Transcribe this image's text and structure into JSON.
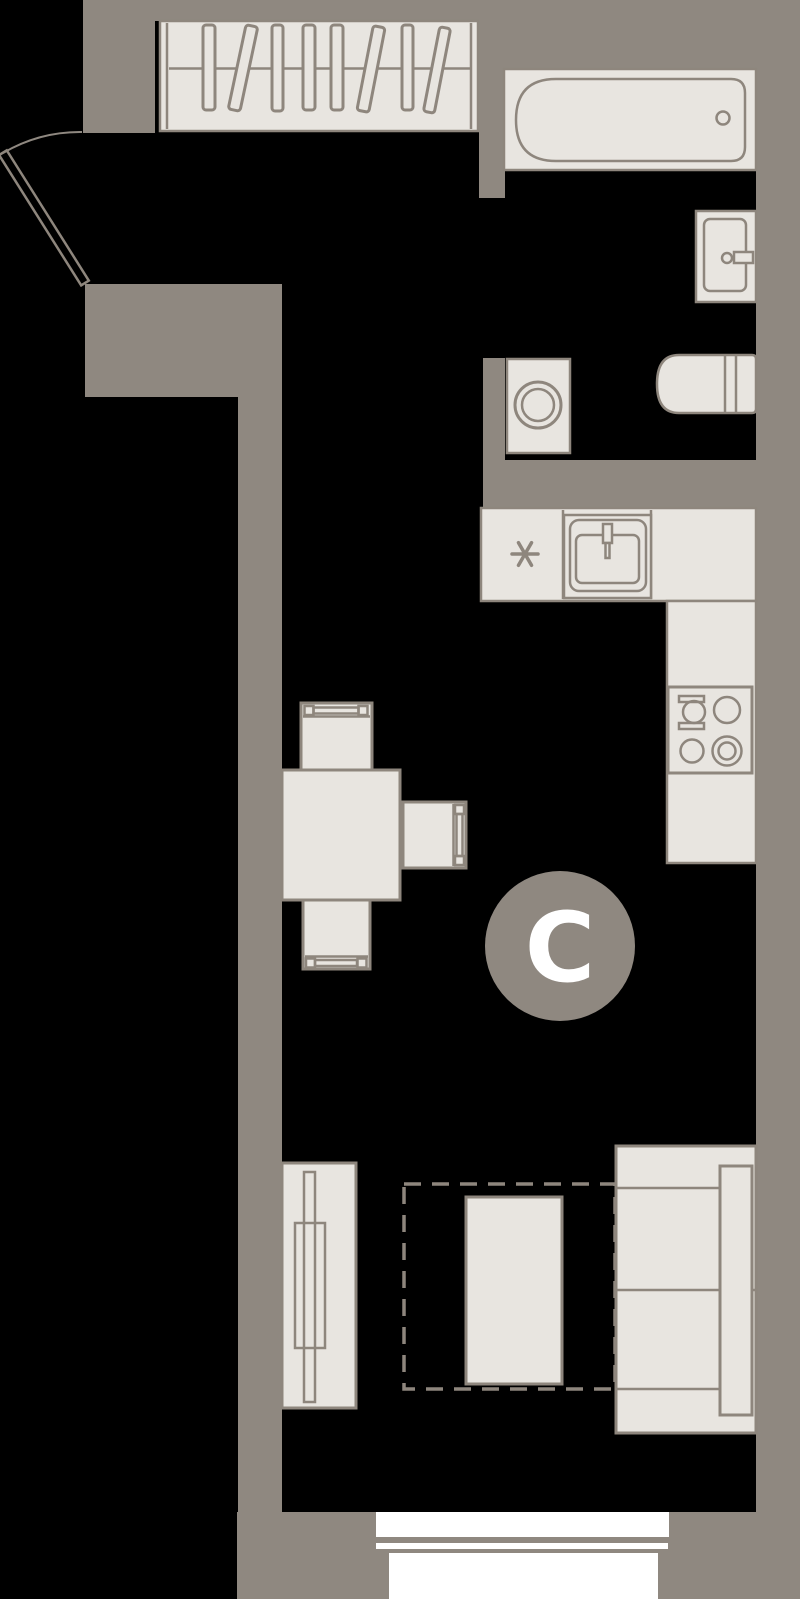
{
  "plan": {
    "title": "studio-apartment-floor-plan",
    "badge": {
      "label": "С"
    },
    "colors": {
      "background": "#000000",
      "wall": "#8f8880",
      "furniture_fill": "#e8e5e0",
      "outline": "#8e867d",
      "window": "#ffffff",
      "badge_text": "#ffffff"
    },
    "items": [
      "entrance-door",
      "wardrobe-with-hangers",
      "bathtub",
      "washbasin",
      "washing-machine",
      "toilet",
      "kitchen-counter",
      "kitchen-sink",
      "dishwasher-place-asterisk",
      "hob-4-burners",
      "dining-table",
      "dining-chairs",
      "tv-stand",
      "sofa",
      "crib-with-clearance",
      "window"
    ]
  }
}
